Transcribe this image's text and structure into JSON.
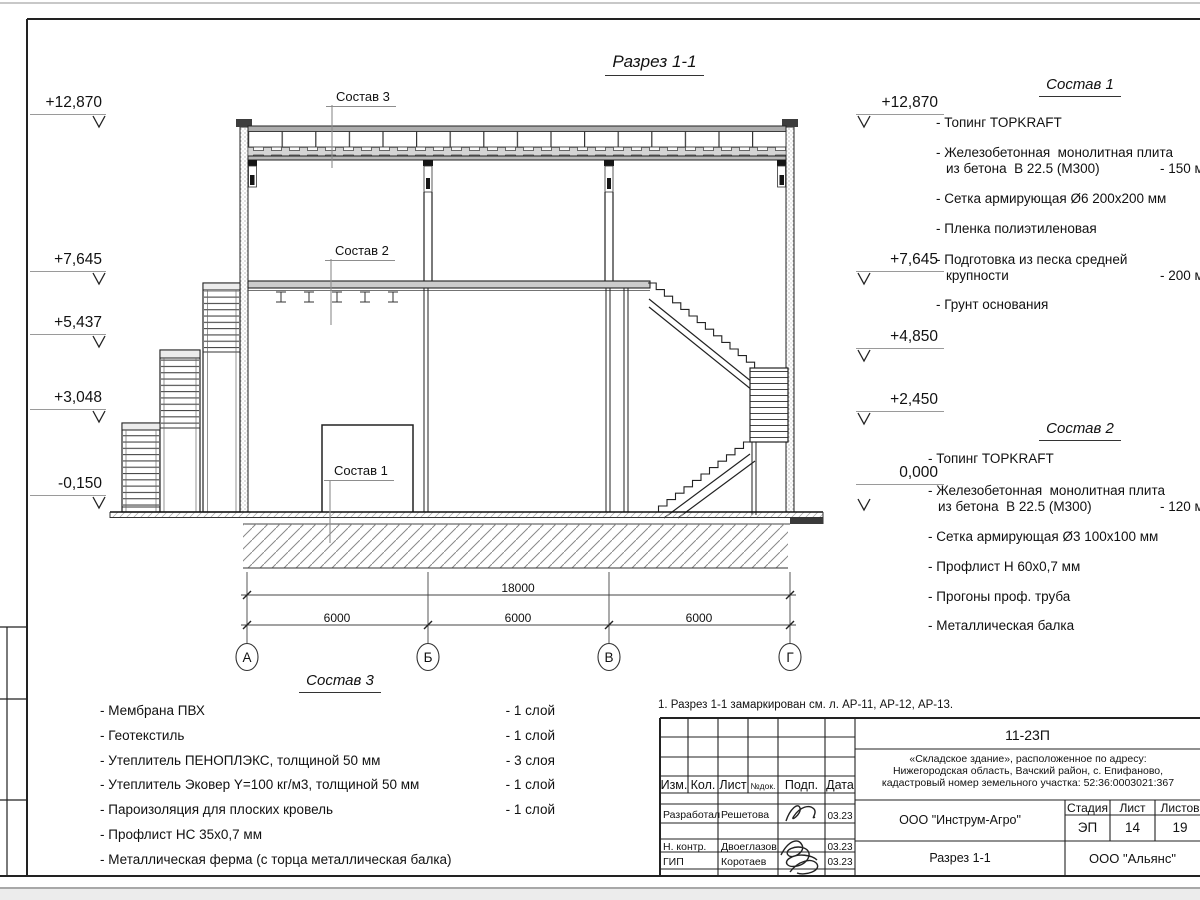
{
  "drawing": {
    "title": "Разрез 1-1",
    "elevations": {
      "left": [
        "+12,870",
        "+7,645",
        "+5,437",
        "+3,048",
        "-0,150"
      ],
      "right": [
        "+12,870",
        "+7,645",
        "+4,850",
        "+2,450",
        "0,000"
      ]
    },
    "dimensions": {
      "total": "18000",
      "bays": [
        "6000",
        "6000",
        "6000"
      ]
    },
    "axes": {
      "labels": [
        "А",
        "Б",
        "В",
        "Г"
      ]
    },
    "callouts": {
      "c1": "Состав 1",
      "c2": "Состав 2",
      "c3": "Состав 3"
    }
  },
  "comp1": {
    "header": "Состав 1",
    "rows": [
      {
        "text": "- Топинг TOPKRAFT"
      },
      {
        "text": "- Железобетонная  монолитная плита"
      },
      {
        "text": "из бетона  В 22.5 (М300)",
        "value": "- 150 мм"
      },
      {
        "text": "- Сетка армирующая Ø6 200x200 мм"
      },
      {
        "text": "- Пленка полиэтиленовая"
      },
      {
        "text": "- Подготовка из песка средней"
      },
      {
        "text": "крупности",
        "value": "- 200 мм"
      },
      {
        "text": "- Грунт основания"
      }
    ]
  },
  "comp2": {
    "header": "Состав 2",
    "rows": [
      {
        "text": "- Топинг TOPKRAFT"
      },
      {
        "text": "- Железобетонная  монолитная плита"
      },
      {
        "text": "из бетона  В 22.5 (М300)",
        "value": "- 120 мм"
      },
      {
        "text": "- Сетка армирующая Ø3 100x100 мм"
      },
      {
        "text": "- Профлист Н 60x0,7 мм"
      },
      {
        "text": "- Прогоны проф. труба"
      },
      {
        "text": "- Металлическая балка"
      }
    ]
  },
  "comp3": {
    "header": "Состав 3",
    "rows": [
      {
        "text": "- Мембрана ПВХ",
        "value": "- 1 слой"
      },
      {
        "text": "- Геотекстиль",
        "value": "- 1 слой"
      },
      {
        "text": "- Утеплитель ПЕНОПЛЭКС, толщиной 50 мм",
        "value": "- 3 слоя"
      },
      {
        "text": "- Утеплитель Эковер Y=100 кг/м3, толщиной 50 мм",
        "value": "- 1 слой"
      },
      {
        "text": "- Пароизоляция для плоских кровель",
        "value": "- 1 слой"
      },
      {
        "text": "- Профлист НС 35x0,7 мм"
      },
      {
        "text": "- Металлическая ферма (с торца металлическая балка)"
      }
    ]
  },
  "note": "1. Разрез 1-1 замаркирован см. л. АР-11, АР-12, АР-13.",
  "titleblock": {
    "doc_number": "11-23П",
    "object_line1": "«Складское здание», расположенное по адресу:",
    "object_line2": "Нижегородская область, Вачский район, с. Епифаново,",
    "object_line3": "кадастровый номер земельного участка: 52:36:0003021:367",
    "client": "ООО \"Инструм-Агро\"",
    "sheet_title": "Разрез 1-1",
    "organization": "ООО \"Альянс\"",
    "stage_label": "Стадия",
    "sheet_label": "Лист",
    "sheets_label": "Листов",
    "stage": "ЭП",
    "sheet": "14",
    "sheets": "19",
    "cols": {
      "izm": "Изм.",
      "kol": "Кол.",
      "list": "Лист",
      "doc": "№док.",
      "podp": "Подп.",
      "data": "Дата"
    },
    "roles": [
      {
        "role": "Разработал",
        "name": "Решетова",
        "date": "03.23"
      },
      {
        "role": "Н. контр.",
        "name": "Двоеглазов",
        "date": "03.23"
      },
      {
        "role": "ГИП",
        "name": "Коротаев",
        "date": "03.23"
      }
    ]
  },
  "colors": {
    "line": "#222222",
    "gray_line": "#9a9a9a",
    "hatch": "#888888",
    "fill_gray": "#b8b8b8"
  }
}
